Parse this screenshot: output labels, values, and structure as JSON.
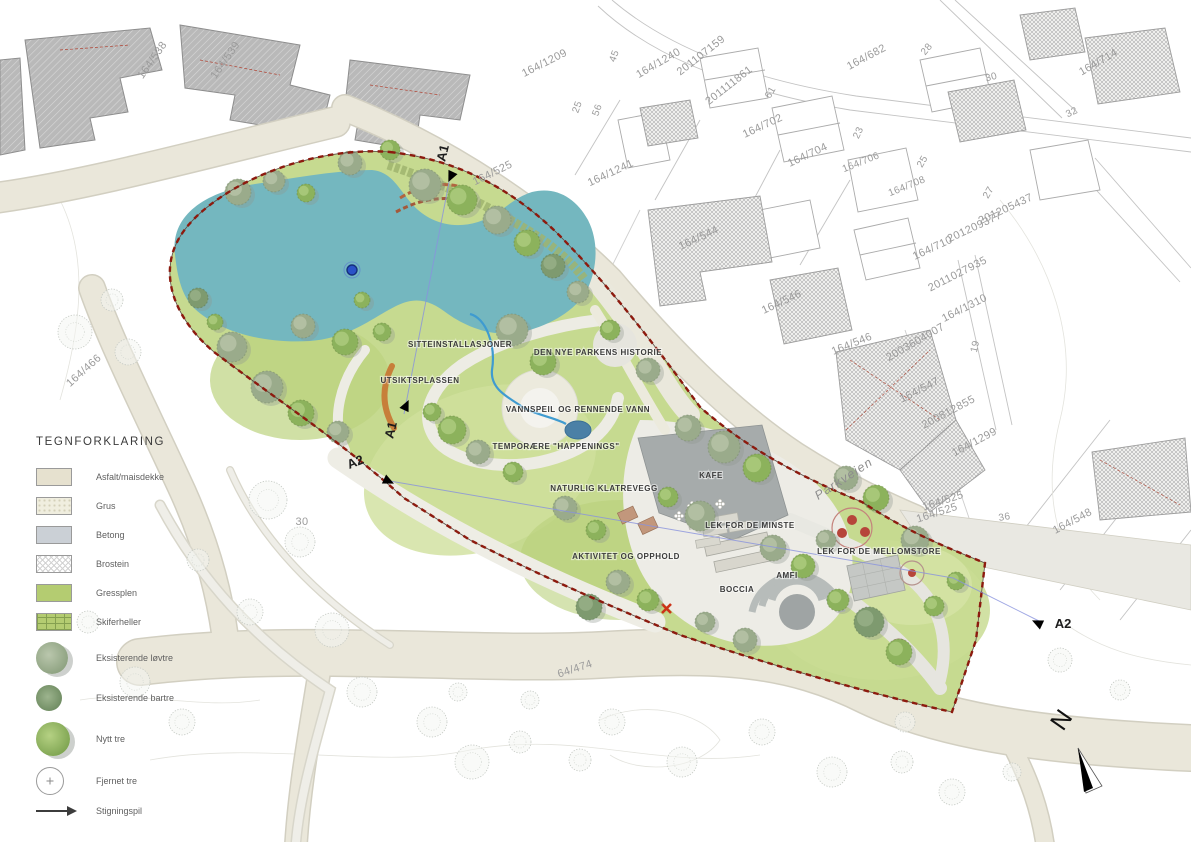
{
  "legend": {
    "title": "TEGNFORKLARING",
    "items": [
      {
        "label": "Asfalt/maisdekke"
      },
      {
        "label": "Grus"
      },
      {
        "label": "Betong"
      },
      {
        "label": "Brostein"
      },
      {
        "label": "Gressplen"
      },
      {
        "label": "Skiferheller"
      },
      {
        "label": "Eksisterende løvtre"
      },
      {
        "label": "Eksisterende bartre"
      },
      {
        "label": "Nytt tre"
      },
      {
        "label": "Fjernet tre"
      },
      {
        "label": "Stigningspil"
      }
    ]
  },
  "park_labels": [
    {
      "text": "SITTEINSTALLASJONER",
      "x": 460,
      "y": 347
    },
    {
      "text": "UTSIKTSPLASSEN",
      "x": 420,
      "y": 383
    },
    {
      "text": "DEN NYE PARKENS HISTORIE",
      "x": 598,
      "y": 355
    },
    {
      "text": "VANNSPEIL OG RENNENDE VANN",
      "x": 578,
      "y": 412
    },
    {
      "text": "TEMPORÆRE \"HAPPENINGS\"",
      "x": 556,
      "y": 449
    },
    {
      "text": "NATURLIG KLATREVEGG",
      "x": 604,
      "y": 491
    },
    {
      "text": "KAFE",
      "x": 711,
      "y": 478
    },
    {
      "text": "LEK FOR DE MINSTE",
      "x": 750,
      "y": 528
    },
    {
      "text": "AKTIVITET OG OPPHOLD",
      "x": 626,
      "y": 559
    },
    {
      "text": "LEK FOR DE MELLOMSTORE",
      "x": 879,
      "y": 554
    },
    {
      "text": "AMFI",
      "x": 787,
      "y": 578
    },
    {
      "text": "BOCCIA",
      "x": 737,
      "y": 592
    }
  ],
  "cadastral_labels": [
    {
      "t": "164/538",
      "x": 155,
      "y": 62,
      "r": -55
    },
    {
      "t": "164/539",
      "x": 228,
      "y": 62,
      "r": -55
    },
    {
      "t": "164/1209",
      "x": 546,
      "y": 66,
      "r": -27
    },
    {
      "t": "164/1241",
      "x": 612,
      "y": 176,
      "r": -25
    },
    {
      "t": "164/1240",
      "x": 660,
      "y": 66,
      "r": -30
    },
    {
      "t": "201107159",
      "x": 703,
      "y": 58,
      "r": -38
    },
    {
      "t": "201111861",
      "x": 731,
      "y": 88,
      "r": -38
    },
    {
      "t": "164/702",
      "x": 764,
      "y": 129,
      "r": -25
    },
    {
      "t": "164/704",
      "x": 809,
      "y": 158,
      "r": -25
    },
    {
      "t": "164/706",
      "x": 862,
      "y": 165,
      "r": -22,
      "s": 10
    },
    {
      "t": "164/708",
      "x": 908,
      "y": 189,
      "r": -22,
      "s": 10
    },
    {
      "t": "164/682",
      "x": 868,
      "y": 60,
      "r": -28
    },
    {
      "t": "164/714",
      "x": 1100,
      "y": 65,
      "r": -30
    },
    {
      "t": "28",
      "x": 929,
      "y": 51,
      "r": -50,
      "s": 10
    },
    {
      "t": "30",
      "x": 992,
      "y": 80,
      "r": -15,
      "s": 10
    },
    {
      "t": "32",
      "x": 1073,
      "y": 115,
      "r": -25,
      "s": 10
    },
    {
      "t": "23",
      "x": 861,
      "y": 134,
      "r": -65,
      "s": 10
    },
    {
      "t": "25",
      "x": 925,
      "y": 163,
      "r": -60,
      "s": 10
    },
    {
      "t": "27",
      "x": 991,
      "y": 194,
      "r": -60,
      "s": 10
    },
    {
      "t": "61",
      "x": 773,
      "y": 94,
      "r": -60,
      "s": 10
    },
    {
      "t": "45",
      "x": 617,
      "y": 57,
      "r": -70,
      "s": 10
    },
    {
      "t": "25",
      "x": 580,
      "y": 108,
      "r": -70,
      "s": 10
    },
    {
      "t": "56",
      "x": 600,
      "y": 111,
      "r": -70,
      "s": 10
    },
    {
      "t": "164/544",
      "x": 700,
      "y": 241,
      "r": -25
    },
    {
      "t": "164/546",
      "x": 783,
      "y": 305,
      "r": -25
    },
    {
      "t": "164/546",
      "x": 853,
      "y": 347,
      "r": -22
    },
    {
      "t": "164/547",
      "x": 921,
      "y": 393,
      "r": -27
    },
    {
      "t": "201205437",
      "x": 1007,
      "y": 212,
      "r": -25
    },
    {
      "t": "201209377",
      "x": 976,
      "y": 230,
      "r": -25
    },
    {
      "t": "164/710",
      "x": 934,
      "y": 251,
      "r": -25
    },
    {
      "t": "2011027935",
      "x": 959,
      "y": 277,
      "r": -27
    },
    {
      "t": "164/1310",
      "x": 966,
      "y": 311,
      "r": -27
    },
    {
      "t": "2003604007",
      "x": 917,
      "y": 345,
      "r": -30
    },
    {
      "t": "200812855",
      "x": 950,
      "y": 415,
      "r": -28
    },
    {
      "t": "164/1299",
      "x": 976,
      "y": 445,
      "r": -28
    },
    {
      "t": "164/525",
      "x": 944,
      "y": 504,
      "r": -18
    },
    {
      "t": "164/525",
      "x": 938,
      "y": 516,
      "r": -18
    },
    {
      "t": "36",
      "x": 1005,
      "y": 520,
      "r": -10,
      "s": 10
    },
    {
      "t": "164/548",
      "x": 1074,
      "y": 524,
      "r": -28
    },
    {
      "t": "19",
      "x": 978,
      "y": 347,
      "r": -78,
      "s": 10
    },
    {
      "t": "164/525",
      "x": 494,
      "y": 176,
      "r": -26
    },
    {
      "t": "164/466",
      "x": 86,
      "y": 373,
      "r": -42
    },
    {
      "t": "64/474",
      "x": 576,
      "y": 672,
      "r": -18
    },
    {
      "t": "30",
      "x": 302,
      "y": 525,
      "r": 0
    }
  ],
  "sections": [
    {
      "label": "A1",
      "tx": 447,
      "ty": 154,
      "trot": -76,
      "px": 453,
      "py": 172,
      "pa": 115
    },
    {
      "label": "A1",
      "tx": 395,
      "ty": 431,
      "trot": -76,
      "px": 404,
      "py": 410,
      "pa": -65
    },
    {
      "label": "A2",
      "tx": 357,
      "ty": 466,
      "trot": -22,
      "px": 384,
      "py": 479,
      "pa": 25
    },
    {
      "label": "A2",
      "tx": 1063,
      "ty": 628,
      "trot": 0,
      "px": 1042,
      "py": 625,
      "pa": 205
    }
  ],
  "street": {
    "name": "Parkveien",
    "x": 846,
    "y": 482,
    "rot": -33
  },
  "north": {
    "label": "N"
  },
  "trees": {
    "park": [
      [
        425,
        185,
        16,
        "e"
      ],
      [
        462,
        200,
        15,
        "g"
      ],
      [
        497,
        220,
        14,
        "e"
      ],
      [
        527,
        243,
        13,
        "g"
      ],
      [
        553,
        266,
        12,
        "c"
      ],
      [
        578,
        292,
        11,
        "e"
      ],
      [
        350,
        163,
        12,
        "e"
      ],
      [
        390,
        150,
        10,
        "g"
      ],
      [
        238,
        192,
        13,
        "e"
      ],
      [
        274,
        181,
        11,
        "e"
      ],
      [
        306,
        193,
        9,
        "g"
      ],
      [
        198,
        298,
        10,
        "c"
      ],
      [
        232,
        347,
        15,
        "e"
      ],
      [
        267,
        387,
        16,
        "e"
      ],
      [
        301,
        413,
        13,
        "g"
      ],
      [
        338,
        432,
        11,
        "e"
      ],
      [
        215,
        322,
        8,
        "g"
      ],
      [
        303,
        326,
        12,
        "e"
      ],
      [
        345,
        342,
        13,
        "g"
      ],
      [
        382,
        332,
        9,
        "g"
      ],
      [
        362,
        300,
        8,
        "g"
      ],
      [
        452,
        430,
        14,
        "g"
      ],
      [
        478,
        452,
        12,
        "e"
      ],
      [
        432,
        412,
        9,
        "g"
      ],
      [
        513,
        472,
        10,
        "g"
      ],
      [
        512,
        330,
        16,
        "e"
      ],
      [
        543,
        362,
        13,
        "g"
      ],
      [
        610,
        330,
        10,
        "g"
      ],
      [
        648,
        370,
        12,
        "e"
      ],
      [
        688,
        428,
        13,
        "e"
      ],
      [
        724,
        447,
        16,
        "e"
      ],
      [
        757,
        468,
        14,
        "g"
      ],
      [
        700,
        516,
        15,
        "e"
      ],
      [
        668,
        497,
        10,
        "g"
      ],
      [
        565,
        508,
        12,
        "e"
      ],
      [
        596,
        530,
        10,
        "g"
      ],
      [
        618,
        582,
        12,
        "e"
      ],
      [
        648,
        600,
        11,
        "g"
      ],
      [
        589,
        607,
        13,
        "c"
      ],
      [
        773,
        548,
        13,
        "e"
      ],
      [
        803,
        566,
        12,
        "g"
      ],
      [
        826,
        540,
        10,
        "e"
      ],
      [
        846,
        478,
        12,
        "e"
      ],
      [
        876,
        498,
        13,
        "g"
      ],
      [
        915,
        540,
        14,
        "e"
      ],
      [
        869,
        622,
        15,
        "c"
      ],
      [
        899,
        652,
        13,
        "g"
      ],
      [
        934,
        606,
        10,
        "g"
      ],
      [
        956,
        581,
        9,
        "g"
      ],
      [
        838,
        600,
        11,
        "g"
      ],
      [
        705,
        622,
        10,
        "e"
      ],
      [
        745,
        640,
        12,
        "e"
      ]
    ],
    "faint": [
      [
        75,
        332,
        17
      ],
      [
        128,
        352,
        13
      ],
      [
        112,
        300,
        11
      ],
      [
        268,
        500,
        19
      ],
      [
        300,
        542,
        15
      ],
      [
        332,
        630,
        17
      ],
      [
        362,
        692,
        15
      ],
      [
        250,
        612,
        13
      ],
      [
        198,
        560,
        11
      ],
      [
        432,
        722,
        15
      ],
      [
        472,
        762,
        17
      ],
      [
        520,
        742,
        11
      ],
      [
        458,
        692,
        9
      ],
      [
        612,
        722,
        13
      ],
      [
        682,
        762,
        15
      ],
      [
        762,
        732,
        13
      ],
      [
        832,
        772,
        15
      ],
      [
        902,
        762,
        11
      ],
      [
        952,
        792,
        13
      ],
      [
        1012,
        772,
        9
      ],
      [
        135,
        682,
        15
      ],
      [
        88,
        622,
        11
      ],
      [
        182,
        722,
        13
      ],
      [
        530,
        700,
        9
      ],
      [
        580,
        760,
        11
      ],
      [
        905,
        722,
        10
      ],
      [
        1060,
        660,
        12
      ],
      [
        1120,
        690,
        10
      ]
    ]
  },
  "colors": {
    "pond": "#74b7bf",
    "grass": "#c6da90",
    "road": "#eae7da",
    "concrete": "#a6abab",
    "boundary_red": "#8d1a0e",
    "section_blue": "#8892dd",
    "stream_blue": "#3f9bd0"
  }
}
